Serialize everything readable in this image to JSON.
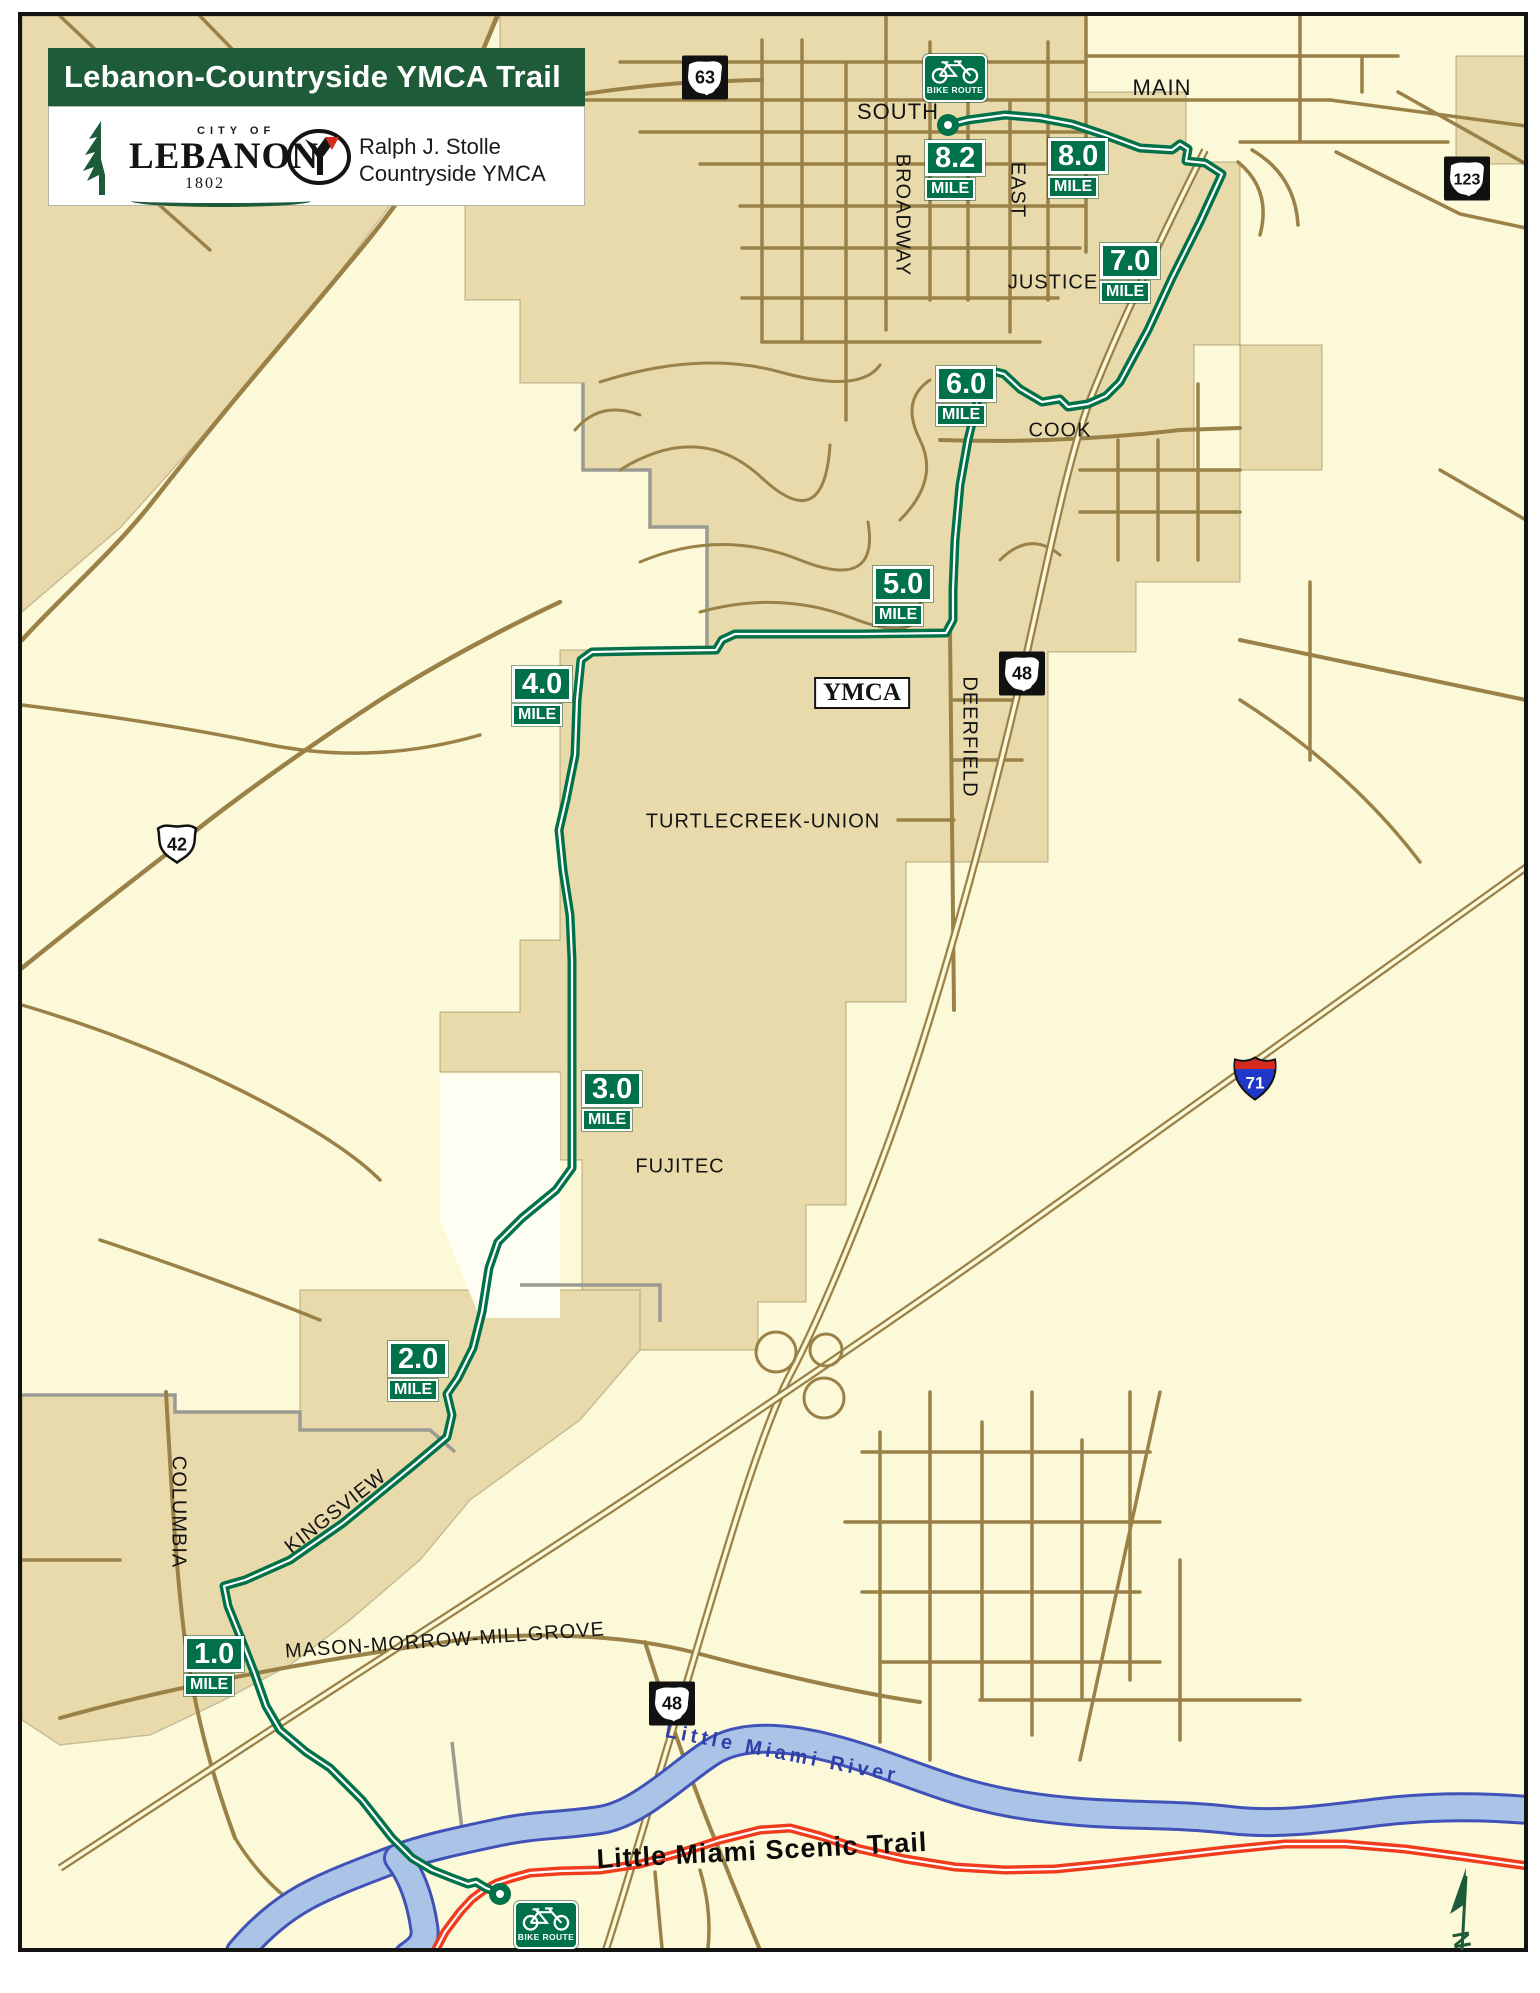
{
  "header": {
    "title": "Lebanon-Countryside YMCA Trail",
    "lebanon_logo": {
      "city_of": "CITY OF",
      "name": "LEBANON",
      "year": "1802"
    },
    "ymca_logo": {
      "line1": "Ralph J. Stolle",
      "line2": "Countryside YMCA"
    }
  },
  "mile_markers": [
    {
      "value": "8.2",
      "unit": "MILE"
    },
    {
      "value": "8.0",
      "unit": "MILE"
    },
    {
      "value": "7.0",
      "unit": "MILE"
    },
    {
      "value": "6.0",
      "unit": "MILE"
    },
    {
      "value": "5.0",
      "unit": "MILE"
    },
    {
      "value": "4.0",
      "unit": "MILE"
    },
    {
      "value": "3.0",
      "unit": "MILE"
    },
    {
      "value": "2.0",
      "unit": "MILE"
    },
    {
      "value": "1.0",
      "unit": "MILE"
    }
  ],
  "streets": {
    "main": "MAIN",
    "south": "SOUTH",
    "broadway": "BROADWAY",
    "east": "EAST",
    "justice": "JUSTICE",
    "cook": "COOK",
    "deerfield": "DEERFIELD",
    "turtlecreek": "TURTLECREEK-UNION",
    "fujitec": "FUJITEC",
    "kingsview": "KINGSVIEW",
    "columbia": "COLUMBIA",
    "mason": "MASON-MORROW-MILLGROVE"
  },
  "places": {
    "ymca": "YMCA"
  },
  "water": {
    "river": "Little Miami River"
  },
  "trails": {
    "scenic": "Little Miami Scenic Trail"
  },
  "shields": {
    "sr63": "63",
    "sr123": "123",
    "sr48_north": "48",
    "sr48_south": "48",
    "us42": "42",
    "i71": "71"
  },
  "signs": {
    "bike_route_top": "BIKE ROUTE",
    "bike_route_bottom": "BIKE ROUTE"
  },
  "compass": {
    "north": "N"
  },
  "colors": {
    "trail_green": "#007148",
    "banner_green": "#1E5B38",
    "scenic_trail_red": "#F03B1C",
    "urban_tan": "#E9DAAC",
    "rural_cream": "#FCF9D8",
    "road_brown": "#9A8148",
    "river_fill": "#A9C4E6",
    "river_outline": "#4052B8"
  }
}
